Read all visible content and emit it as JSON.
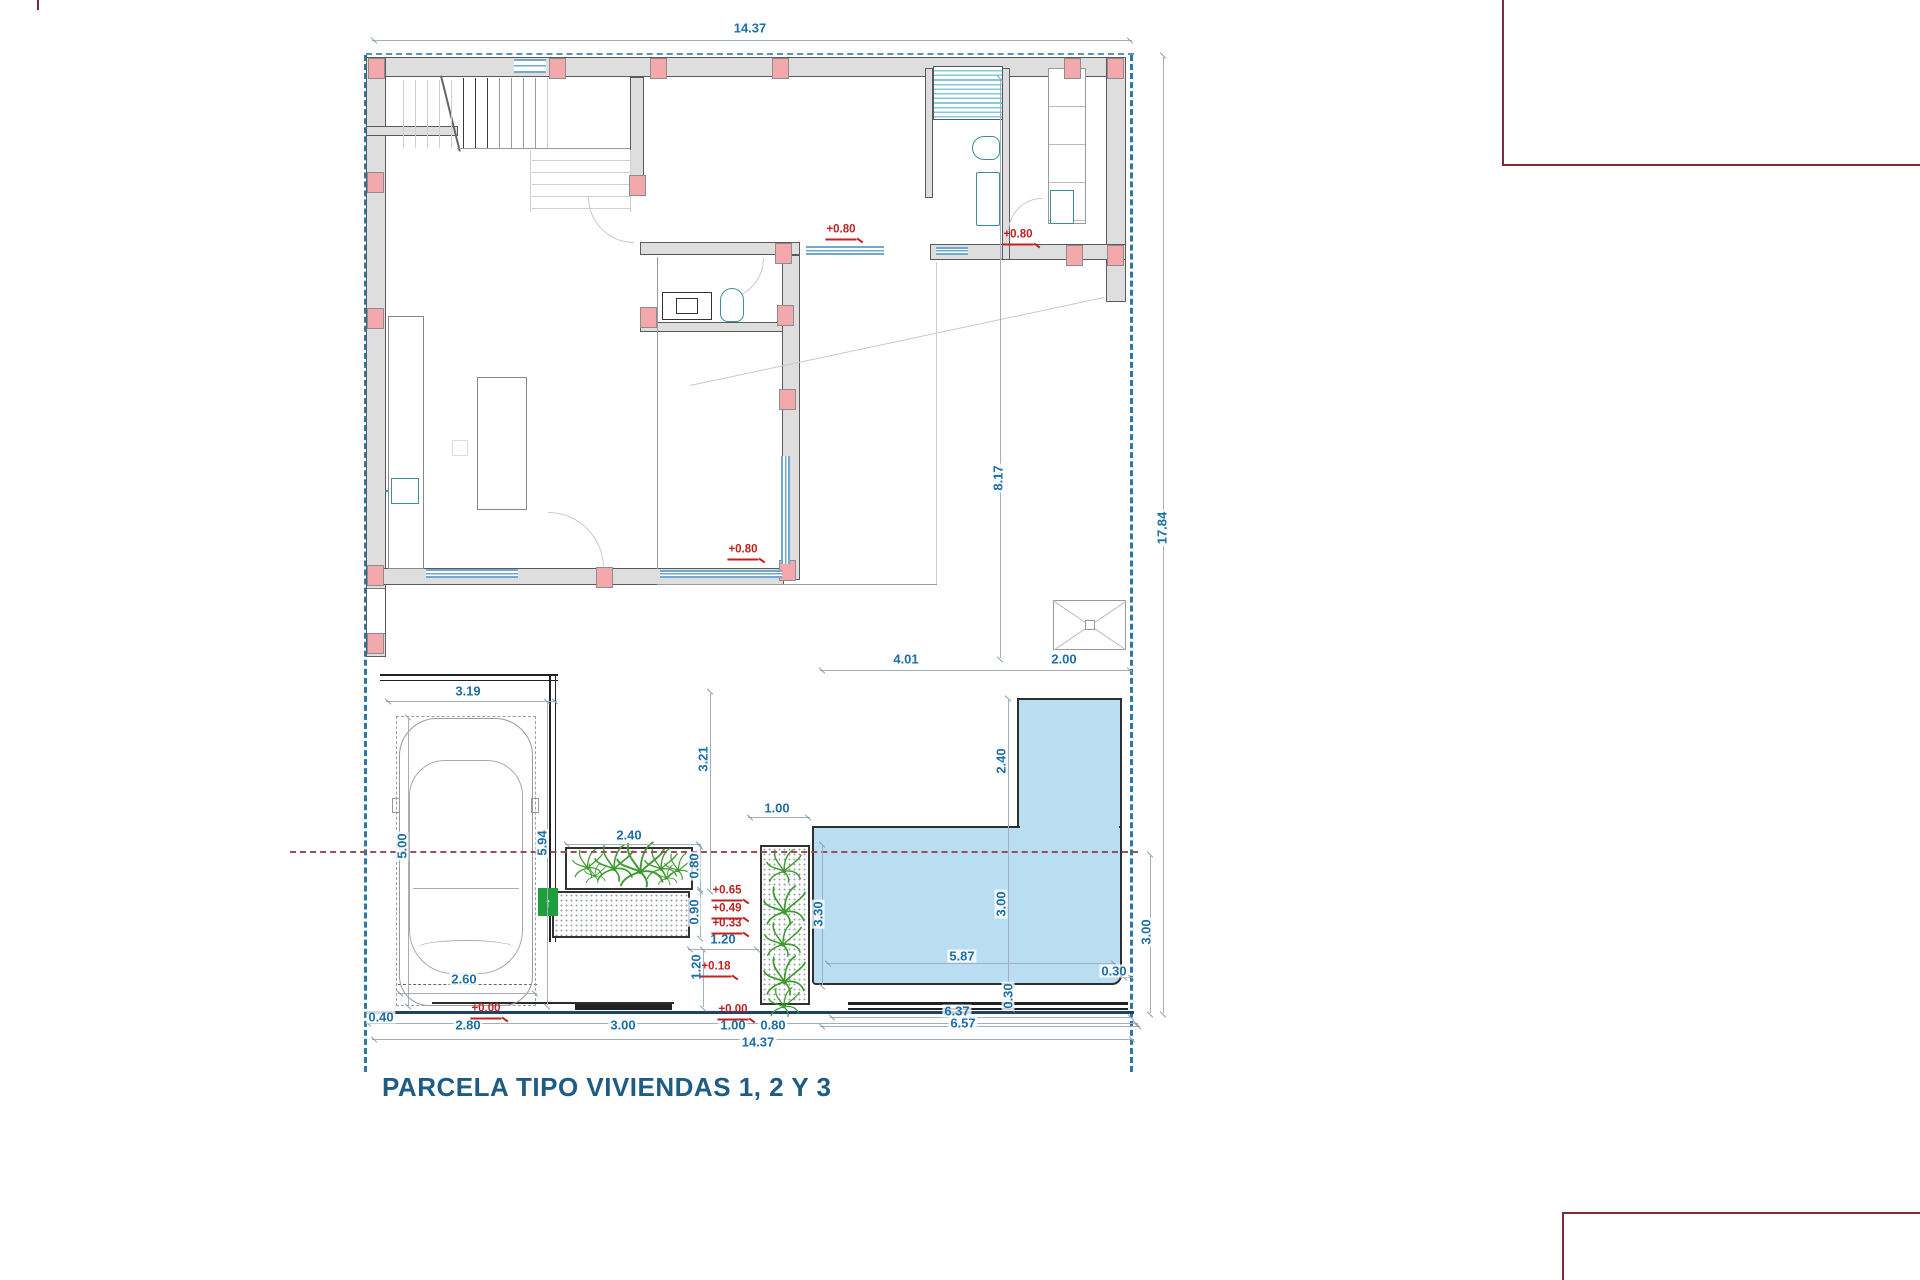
{
  "title": {
    "text": "PARCELA TIPO VIVIENDAS 1, 2 Y 3"
  },
  "colors": {
    "dimension_blue": "#1d6fa8",
    "level_red": "#c42020",
    "boundary_teal": "#2e76a4",
    "street_navy": "#1d4468",
    "wall_gray": "#dedede",
    "column_pink": "#f3a9ab",
    "pool_fill": "#b9ddf1",
    "plant_green": "#3f9b2f",
    "frame_maroon": "#7d2b3a",
    "title_blue": "#1e5c84"
  },
  "dimensions": [
    {
      "text": "14.37",
      "x": 750,
      "y": 28,
      "rot": 0
    },
    {
      "text": "14.37",
      "x": 758,
      "y": 1042,
      "rot": 0
    },
    {
      "text": "17.84",
      "x": 1162,
      "y": 528,
      "rot": -90
    },
    {
      "text": "8.17",
      "x": 998,
      "y": 478,
      "rot": -90
    },
    {
      "text": "4.01",
      "x": 906,
      "y": 659,
      "rot": 0
    },
    {
      "text": "2.00",
      "x": 1064,
      "y": 659,
      "rot": 0
    },
    {
      "text": "2.40",
      "x": 1001,
      "y": 761,
      "rot": -90
    },
    {
      "text": "3.00",
      "x": 1001,
      "y": 904,
      "rot": -90
    },
    {
      "text": "3.30",
      "x": 818,
      "y": 914,
      "rot": -90
    },
    {
      "text": "5.87",
      "x": 962,
      "y": 956,
      "rot": 0
    },
    {
      "text": "0.30",
      "x": 1008,
      "y": 996,
      "rot": -90
    },
    {
      "text": "0.30",
      "x": 1114,
      "y": 971,
      "rot": 0
    },
    {
      "text": "3.00",
      "x": 1146,
      "y": 932,
      "rot": -90
    },
    {
      "text": "3.21",
      "x": 703,
      "y": 759,
      "rot": -90
    },
    {
      "text": "2.40",
      "x": 629,
      "y": 835,
      "rot": 0
    },
    {
      "text": "1.00",
      "x": 777,
      "y": 808,
      "rot": 0
    },
    {
      "text": "0.80",
      "x": 694,
      "y": 866,
      "rot": -90
    },
    {
      "text": "0.90",
      "x": 694,
      "y": 912,
      "rot": -90
    },
    {
      "text": "1.20",
      "x": 723,
      "y": 939,
      "rot": 0
    },
    {
      "text": "1.20",
      "x": 696,
      "y": 967,
      "rot": -90
    },
    {
      "text": "3.19",
      "x": 468,
      "y": 691,
      "rot": 0
    },
    {
      "text": "5.00",
      "x": 402,
      "y": 846,
      "rot": -90
    },
    {
      "text": "5.94",
      "x": 542,
      "y": 843,
      "rot": -90
    },
    {
      "text": "2.60",
      "x": 464,
      "y": 979,
      "rot": 0
    },
    {
      "text": "0.40",
      "x": 381,
      "y": 1017,
      "rot": 0
    },
    {
      "text": "2.80",
      "x": 468,
      "y": 1025,
      "rot": 0
    },
    {
      "text": "3.00",
      "x": 623,
      "y": 1025,
      "rot": 0
    },
    {
      "text": "1.00",
      "x": 733,
      "y": 1025,
      "rot": 0
    },
    {
      "text": "0.80",
      "x": 773,
      "y": 1025,
      "rot": 0
    },
    {
      "text": "6.37",
      "x": 957,
      "y": 1011,
      "rot": 0
    },
    {
      "text": "6.57",
      "x": 963,
      "y": 1023,
      "rot": 0
    }
  ],
  "levels": [
    {
      "text": "+0.80",
      "x": 841,
      "y": 240
    },
    {
      "text": "+0.80",
      "x": 1018,
      "y": 245
    },
    {
      "text": "+0.80",
      "x": 743,
      "y": 560
    },
    {
      "text": "+0.65",
      "x": 727,
      "y": 901
    },
    {
      "text": "+0.49",
      "x": 727,
      "y": 919
    },
    {
      "text": "+0.33",
      "x": 727,
      "y": 934
    },
    {
      "text": "+0.18",
      "x": 716,
      "y": 977
    },
    {
      "text": "+0.00",
      "x": 486,
      "y": 1019
    },
    {
      "text": "+0.00",
      "x": 733,
      "y": 1020
    }
  ],
  "dim_lines": [
    {
      "x": 372,
      "y": 40,
      "len": 760,
      "o": "h"
    },
    {
      "x": 1163,
      "y": 57,
      "len": 956,
      "o": "v"
    },
    {
      "x": 1000,
      "y": 80,
      "len": 578,
      "o": "v"
    },
    {
      "x": 820,
      "y": 670,
      "len": 312,
      "o": "h"
    },
    {
      "x": 1008,
      "y": 700,
      "len": 286,
      "o": "v"
    },
    {
      "x": 822,
      "y": 846,
      "len": 139,
      "o": "v"
    },
    {
      "x": 826,
      "y": 963,
      "len": 290,
      "o": "h"
    },
    {
      "x": 1012,
      "y": 986,
      "len": 22,
      "o": "v"
    },
    {
      "x": 1122,
      "y": 977,
      "len": 11,
      "o": "h"
    },
    {
      "x": 1150,
      "y": 856,
      "len": 157,
      "o": "v"
    },
    {
      "x": 710,
      "y": 693,
      "len": 197,
      "o": "v"
    },
    {
      "x": 565,
      "y": 844,
      "len": 136,
      "o": "h"
    },
    {
      "x": 748,
      "y": 817,
      "len": 62,
      "o": "h"
    },
    {
      "x": 700,
      "y": 848,
      "len": 42,
      "o": "v"
    },
    {
      "x": 700,
      "y": 891,
      "len": 46,
      "o": "v"
    },
    {
      "x": 688,
      "y": 949,
      "len": 71,
      "o": "h"
    },
    {
      "x": 703,
      "y": 951,
      "len": 56,
      "o": "v"
    },
    {
      "x": 386,
      "y": 701,
      "len": 171,
      "o": "h"
    },
    {
      "x": 408,
      "y": 719,
      "len": 286,
      "o": "v"
    },
    {
      "x": 547,
      "y": 703,
      "len": 302,
      "o": "v"
    },
    {
      "x": 398,
      "y": 993,
      "len": 139,
      "o": "h"
    },
    {
      "x": 366,
      "y": 1023,
      "len": 772,
      "o": "h"
    },
    {
      "x": 372,
      "y": 1039,
      "len": 762,
      "o": "h"
    },
    {
      "x": 830,
      "y": 1017,
      "len": 303,
      "o": "h"
    },
    {
      "x": 820,
      "y": 1026,
      "len": 320,
      "o": "h"
    }
  ],
  "columns": [
    {
      "x": 368,
      "y": 58
    },
    {
      "x": 549,
      "y": 58
    },
    {
      "x": 650,
      "y": 58
    },
    {
      "x": 772,
      "y": 58
    },
    {
      "x": 1064,
      "y": 58
    },
    {
      "x": 1107,
      "y": 58
    },
    {
      "x": 367,
      "y": 172
    },
    {
      "x": 367,
      "y": 308
    },
    {
      "x": 367,
      "y": 565
    },
    {
      "x": 367,
      "y": 633
    },
    {
      "x": 629,
      "y": 175
    },
    {
      "x": 640,
      "y": 307
    },
    {
      "x": 777,
      "y": 305
    },
    {
      "x": 779,
      "y": 389
    },
    {
      "x": 779,
      "y": 560
    },
    {
      "x": 775,
      "y": 243
    },
    {
      "x": 1066,
      "y": 245
    },
    {
      "x": 1107,
      "y": 245
    },
    {
      "x": 596,
      "y": 567
    }
  ],
  "windows": [
    {
      "x": 426,
      "y": 569,
      "w": 92,
      "h": 9,
      "o": "h"
    },
    {
      "x": 660,
      "y": 570,
      "w": 122,
      "h": 8,
      "o": "h"
    },
    {
      "x": 806,
      "y": 246,
      "w": 78,
      "h": 9,
      "o": "h"
    },
    {
      "x": 936,
      "y": 247,
      "w": 32,
      "h": 8,
      "o": "h"
    },
    {
      "x": 781,
      "y": 456,
      "w": 9,
      "h": 108,
      "o": "v"
    },
    {
      "x": 514,
      "y": 59,
      "w": 32,
      "h": 14,
      "o": "h"
    }
  ],
  "lines": [
    [
      403,
      80,
      68,
      "v",
      "f"
    ],
    [
      415,
      80,
      68,
      "v",
      "f"
    ],
    [
      427,
      80,
      68,
      "v",
      "f"
    ],
    [
      439,
      80,
      68,
      "v",
      "f"
    ],
    [
      451,
      80,
      68,
      "v",
      "f"
    ],
    [
      463,
      78,
      70,
      "v",
      "d"
    ],
    [
      475,
      78,
      70,
      "v",
      "d"
    ],
    [
      487,
      78,
      70,
      "v",
      "d"
    ],
    [
      499,
      78,
      70,
      "v",
      "m"
    ],
    [
      511,
      78,
      70,
      "v",
      "m"
    ],
    [
      523,
      78,
      70,
      "v",
      "m"
    ],
    [
      535,
      78,
      70,
      "v",
      "m"
    ],
    [
      547,
      78,
      70,
      "v",
      "f"
    ],
    [
      457,
      148,
      173,
      "h",
      "m"
    ],
    [
      532,
      160,
      98,
      "h",
      "f"
    ],
    [
      532,
      172,
      98,
      "h",
      "f"
    ],
    [
      532,
      184,
      98,
      "h",
      "f"
    ],
    [
      532,
      196,
      98,
      "h",
      "f"
    ],
    [
      532,
      208,
      98,
      "h",
      "f"
    ],
    [
      530,
      150,
      62,
      "v",
      "f"
    ],
    [
      630,
      150,
      62,
      "v",
      "f"
    ],
    [
      390,
      350,
      34,
      "h",
      "f"
    ],
    [
      390,
      384,
      34,
      "h",
      "f"
    ],
    [
      390,
      430,
      34,
      "h",
      "f"
    ],
    [
      390,
      472,
      34,
      "h",
      "f"
    ],
    [
      390,
      532,
      34,
      "h",
      "f"
    ],
    [
      657,
      257,
      312,
      "v",
      "m"
    ],
    [
      657,
      584,
      280,
      "h",
      "m"
    ],
    [
      936,
      262,
      322,
      "v",
      "f"
    ],
    [
      995,
      70,
      46,
      "v",
      "d"
    ],
    [
      432,
      1002,
      242,
      "h",
      "t"
    ],
    [
      1019,
      708,
      100,
      "h",
      "s"
    ],
    [
      1019,
      778,
      100,
      "h",
      "s"
    ],
    [
      1019,
      793,
      100,
      "h",
      "s"
    ],
    [
      1019,
      807,
      100,
      "h",
      "s"
    ]
  ],
  "plants": [
    {
      "x": 572,
      "y": 848,
      "s": 0.85
    },
    {
      "x": 594,
      "y": 843,
      "s": 1.1
    },
    {
      "x": 616,
      "y": 840,
      "s": 1.35
    },
    {
      "x": 644,
      "y": 847,
      "s": 0.95
    },
    {
      "x": 664,
      "y": 852,
      "s": 0.8
    },
    {
      "x": 584,
      "y": 862,
      "s": 0.6
    },
    {
      "x": 656,
      "y": 864,
      "s": 0.6
    },
    {
      "x": 766,
      "y": 848,
      "s": 1.0
    },
    {
      "x": 763,
      "y": 884,
      "s": 1.2
    },
    {
      "x": 764,
      "y": 920,
      "s": 1.05
    },
    {
      "x": 763,
      "y": 954,
      "s": 1.2
    },
    {
      "x": 768,
      "y": 986,
      "s": 0.9
    }
  ]
}
